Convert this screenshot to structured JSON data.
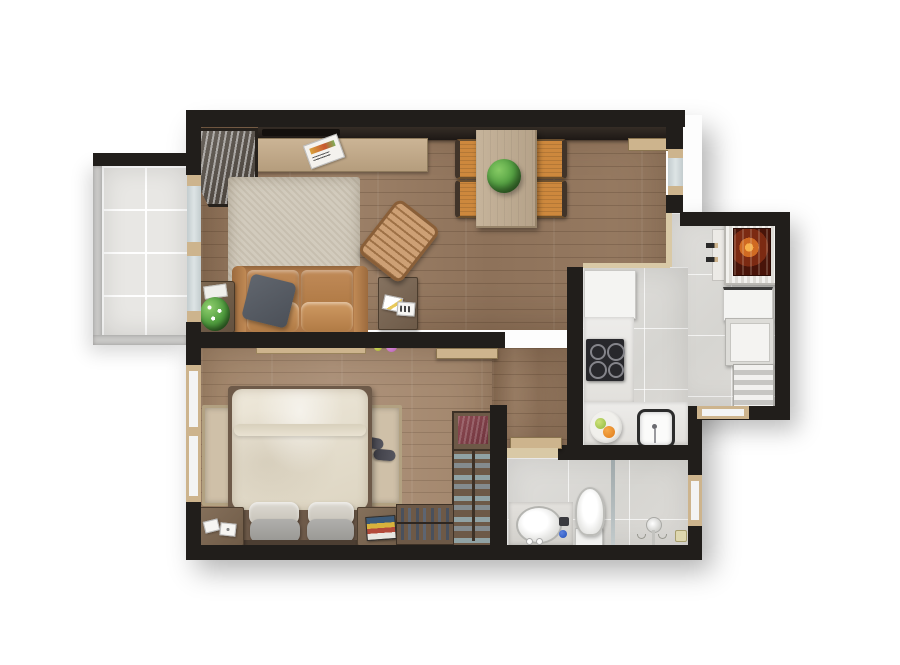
{
  "scene": {
    "kind": "apartment-floor-plan-3d-render",
    "view": "top-down",
    "background": "#ffffff"
  },
  "palette": {
    "wall": "#211e1b",
    "wood_living": "#967a62",
    "wood_bedroom": "#a88d73",
    "tile_balcony": "#e8e7e4",
    "tile_kitchen": "#dbdad6",
    "tile_bathroom": "#d9d8d4",
    "railing_gray": "#c9c8c6",
    "rug_living": "#d2cbbd",
    "rug_bedside": "#cfc0a8",
    "sofa_leather": "#b07a4a",
    "pillow_dark_gray": "#535861",
    "chair_orange": "#cd883d",
    "dining_table": "#beab92",
    "plant_green": "#55a243",
    "bed_linen": "#e9e3d6",
    "frame_beige": "#cdb48d",
    "threshold_beige": "#d9c9a6",
    "glass_blue": "#ccd5d7",
    "fire_orange": "#d06a22",
    "fire_dark": "#481409",
    "counter_white": "#f4f4f2",
    "cooktop_black": "#28282c",
    "closet_brown": "#6d5947",
    "shoe_teal": "#7e999c",
    "clothes_maroon": "#7e3f46"
  },
  "rooms": [
    {
      "id": "balcony"
    },
    {
      "id": "living-room"
    },
    {
      "id": "dining-area"
    },
    {
      "id": "kitchen"
    },
    {
      "id": "gourmet-terrace"
    },
    {
      "id": "hallway"
    },
    {
      "id": "bedroom"
    },
    {
      "id": "bathroom"
    }
  ],
  "furniture": {
    "living_room": [
      "wall-shelf",
      "tv-panel",
      "tv-console",
      "magazine",
      "branch-vase",
      "area-rug",
      "leather-sofa",
      "throw-pillow",
      "plant-side-table",
      "magazine-side-table",
      "wooden-armchair"
    ],
    "dining_area": [
      "dining-table",
      "dining-chair-1",
      "dining-chair-2",
      "dining-chair-3",
      "dining-chair-4",
      "centerpiece-plant"
    ],
    "kitchen": [
      "refrigerator",
      "counter",
      "cooktop",
      "sink",
      "fruit-plate"
    ],
    "gourmet_terrace": [
      "barbecue-grill",
      "grill-tools",
      "side-shelf",
      "prep-counter",
      "cabinet",
      "striped-bench"
    ],
    "bedroom": [
      "wall-shelf",
      "decor-balls",
      "double-bed",
      "duvet",
      "pillows",
      "headboard",
      "nightstand-left",
      "nightstand-right",
      "bedside-rug-left",
      "bedside-rug-right",
      "slippers",
      "wardrobe-clothes-box",
      "shoe-rack",
      "hanging-clothes"
    ],
    "bathroom": [
      "vanity",
      "basin",
      "toilet",
      "shower-glass-partition",
      "shower-head",
      "floor-drain"
    ],
    "openings": [
      "balcony-sliding-door",
      "terrace-sliding-door",
      "bedroom-window",
      "bathroom-window",
      "terrace-window",
      "bedroom-door-leaf",
      "bathroom-door-leaf"
    ]
  }
}
